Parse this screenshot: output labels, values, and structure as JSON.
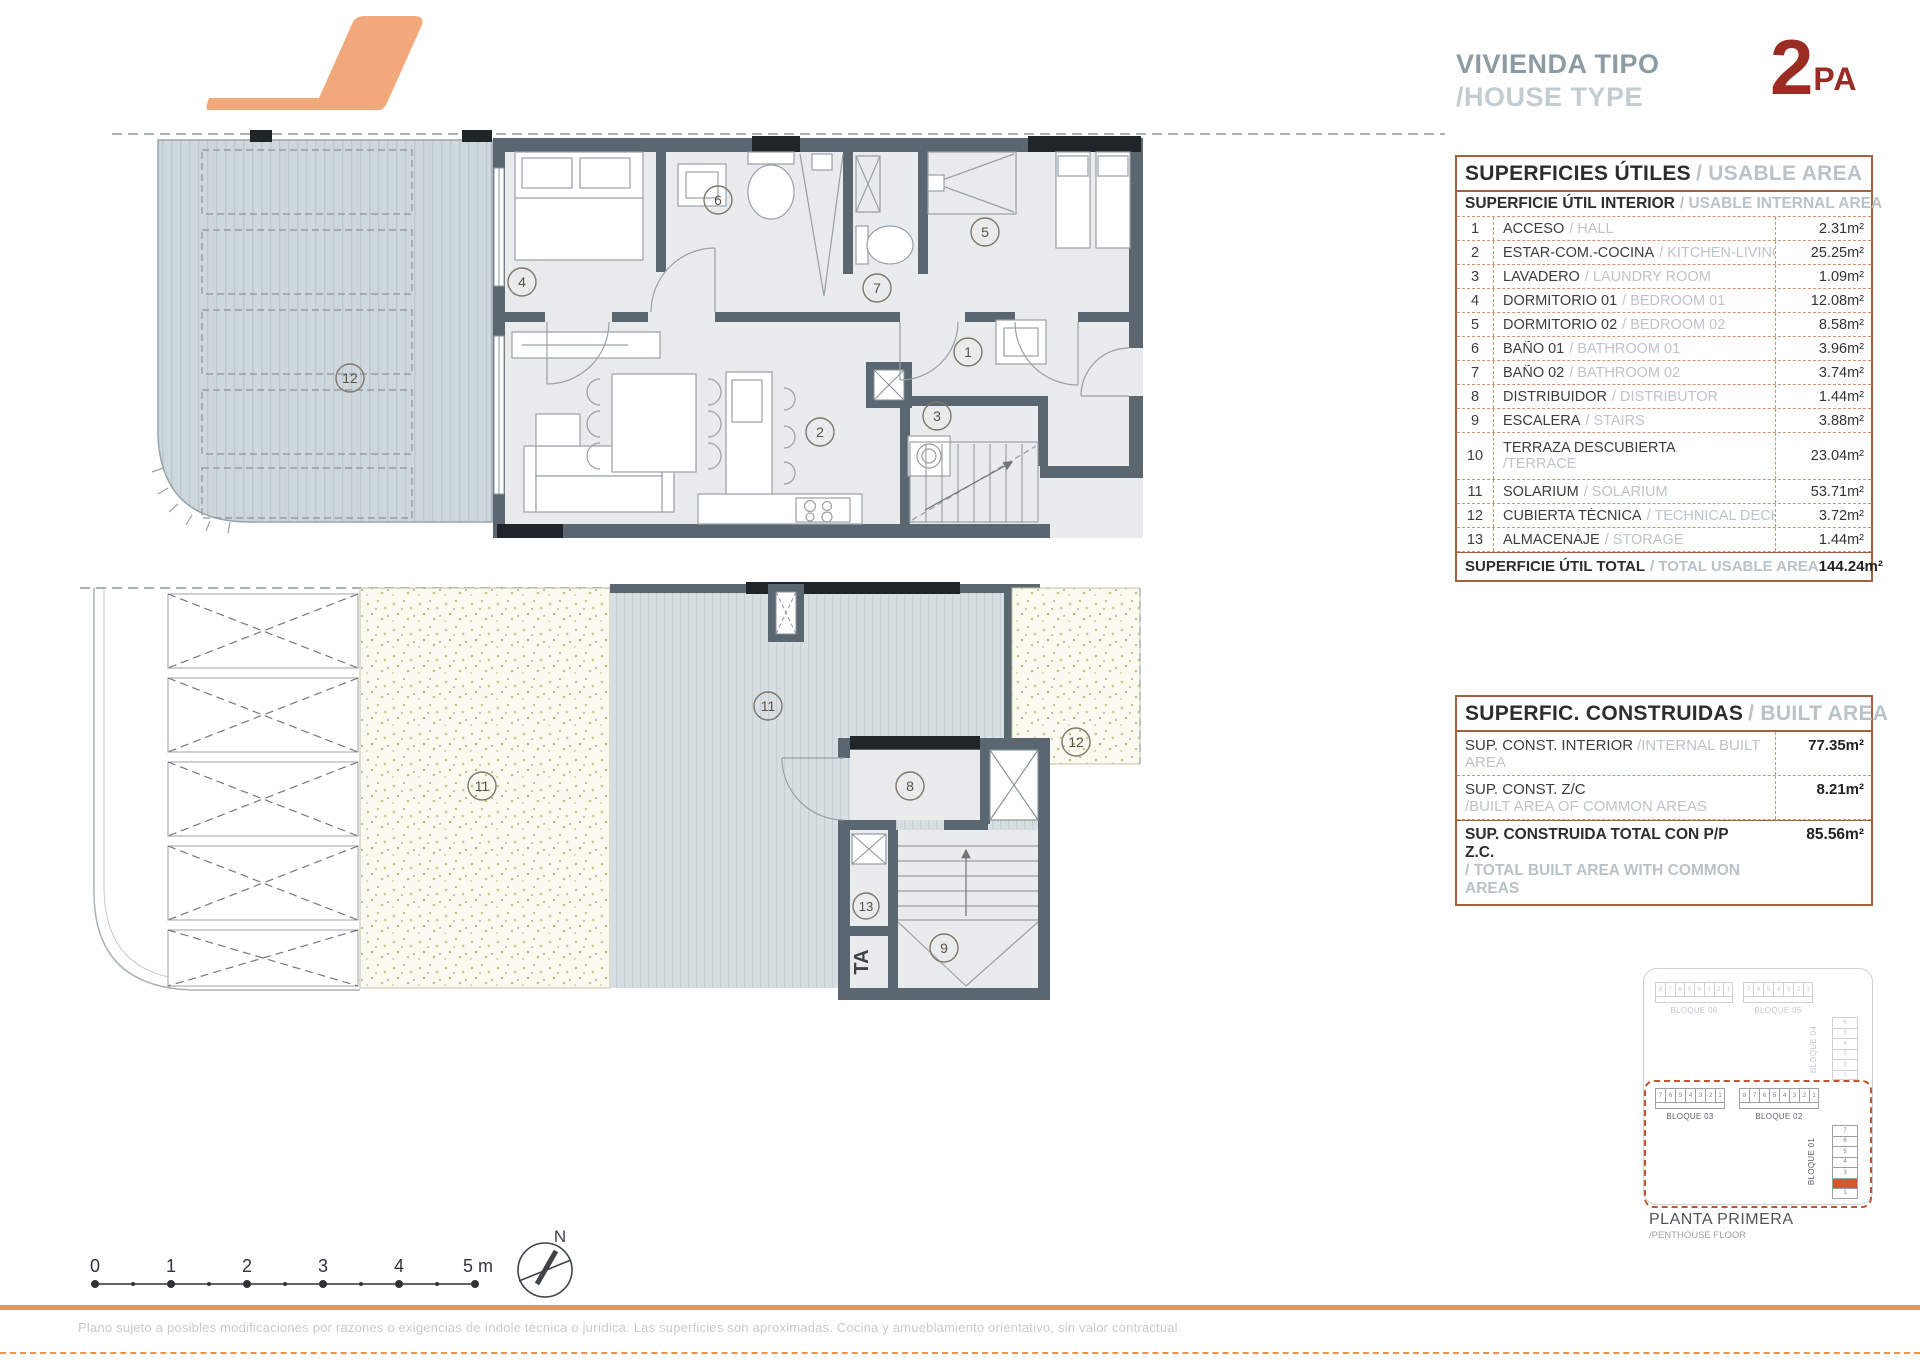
{
  "header": {
    "title_es": "VIVIENDA TIPO",
    "title_en": "/HOUSE TYPE",
    "type_number": "2",
    "type_suffix": "PA"
  },
  "usable": {
    "title_es": "SUPERFICIES ÚTILES",
    "title_en": "/ USABLE AREA",
    "subtitle_es": "SUPERFICIE ÚTIL INTERIOR",
    "subtitle_en": "/ USABLE INTERNAL AREA",
    "rows": [
      {
        "num": "1",
        "es": "ACCESO",
        "en": "/ HALL",
        "val": "2.31m²"
      },
      {
        "num": "2",
        "es": "ESTAR-COM.-COCINA",
        "en": "/ KITCHEN-LIVING",
        "val": "25.25m²"
      },
      {
        "num": "3",
        "es": "LAVADERO",
        "en": "/ LAUNDRY ROOM",
        "val": "1.09m²"
      },
      {
        "num": "4",
        "es": "DORMITORIO 01",
        "en": "/ BEDROOM 01",
        "val": "12.08m²"
      },
      {
        "num": "5",
        "es": "DORMITORIO 02",
        "en": "/ BEDROOM 02",
        "val": "8.58m²"
      },
      {
        "num": "6",
        "es": "BAÑO 01",
        "en": "/ BATHROOM 01",
        "val": "3.96m²"
      },
      {
        "num": "7",
        "es": "BAÑO 02",
        "en": "/ BATHROOM 02",
        "val": "3.74m²"
      },
      {
        "num": "8",
        "es": "DISTRIBUIDOR",
        "en": "/ DISTRIBUTOR",
        "val": "1.44m²"
      },
      {
        "num": "9",
        "es": "ESCALERA",
        "en": "/ STAIRS",
        "val": "3.88m²"
      },
      {
        "num": "10",
        "es": "TERRAZA DESCUBIERTA",
        "en": "/TERRACE",
        "val": "23.04m²"
      },
      {
        "num": "11",
        "es": "SOLARIUM",
        "en": "/ SOLARIUM",
        "val": "53.71m²"
      },
      {
        "num": "12",
        "es": "CUBIERTA TÉCNICA",
        "en": "/ TECHNICAL DECK",
        "val": "3.72m²"
      },
      {
        "num": "13",
        "es": "ALMACENAJE",
        "en": "/ STORAGE",
        "val": "1.44m²"
      }
    ],
    "total_es": "SUPERFICIE ÚTIL TOTAL",
    "total_en": "/ TOTAL USABLE AREA",
    "total_val": "144.24m²"
  },
  "built": {
    "title_es": "SUPERFIC. CONSTRUIDAS",
    "title_en": "/ BUILT AREA",
    "row1_es": "SUP. CONST. INTERIOR",
    "row1_en": "/INTERNAL BUILT AREA",
    "row1_val": "77.35m²",
    "row2_es": "SUP. CONST. Z/C",
    "row2_en": "/BUILT AREA OF COMMON AREAS",
    "row2_val": "8.21m²",
    "total_es": "SUP. CONSTRUIDA TOTAL CON P/P Z.C.",
    "total_en": "/ TOTAL BUILT AREA WITH COMMON AREAS",
    "total_val": "85.56m²"
  },
  "plans": {
    "upper_labels": [
      "12",
      "4",
      "6",
      "7",
      "5",
      "1",
      "3",
      "2"
    ],
    "lower_labels": [
      "11",
      "11",
      "12",
      "8",
      "13",
      "9"
    ],
    "ta": "TA"
  },
  "site": {
    "caption_es": "PLANTA PRIMERA",
    "caption_en": "/PENTHOUSE FLOOR",
    "bloque06": {
      "label": "BLOQUE 06",
      "cells": [
        "8",
        "7",
        "6",
        "5",
        "4",
        "3",
        "2",
        "1"
      ]
    },
    "bloque05": {
      "label": "BLOQUE 05",
      "cells": [
        "7",
        "6",
        "5",
        "4",
        "3",
        "2",
        "1"
      ]
    },
    "bloque04": {
      "label": "BLOQUE 04",
      "cells": [
        "6",
        "5",
        "4",
        "3",
        "2",
        "1"
      ]
    },
    "bloque03": {
      "label": "BLOQUE 03",
      "cells": [
        "7",
        "6",
        "5",
        "4",
        "3",
        "2",
        "1"
      ]
    },
    "bloque02": {
      "label": "BLOQUE 02",
      "cells": [
        "8",
        "7",
        "6",
        "5",
        "4",
        "3",
        "2",
        "1"
      ]
    },
    "bloque01": {
      "label": "BLOQUE 01",
      "cells": [
        "7",
        "6",
        "5",
        "4",
        "3",
        "2",
        "1"
      ]
    }
  },
  "scale": {
    "labels": [
      "0",
      "1",
      "2",
      "3",
      "4",
      "5 m"
    ]
  },
  "compass": {
    "label": "N"
  },
  "footer": {
    "disclaimer": "Plano sujeto a posibles modificaciones por razones o exigencias de índole técnica o jurídica. Las superficies son aproximadas. Cocina y amueblamiento orientativo, sin valor contractual."
  },
  "colors": {
    "accent_orange": "#e8944e",
    "logo_orange": "#f1a87b",
    "brand_red": "#9b2c24",
    "table_border": "#a4613f",
    "wall": "#5b6770",
    "site_dashed": "#c2542e",
    "highlight_cell": "#d6562c"
  }
}
